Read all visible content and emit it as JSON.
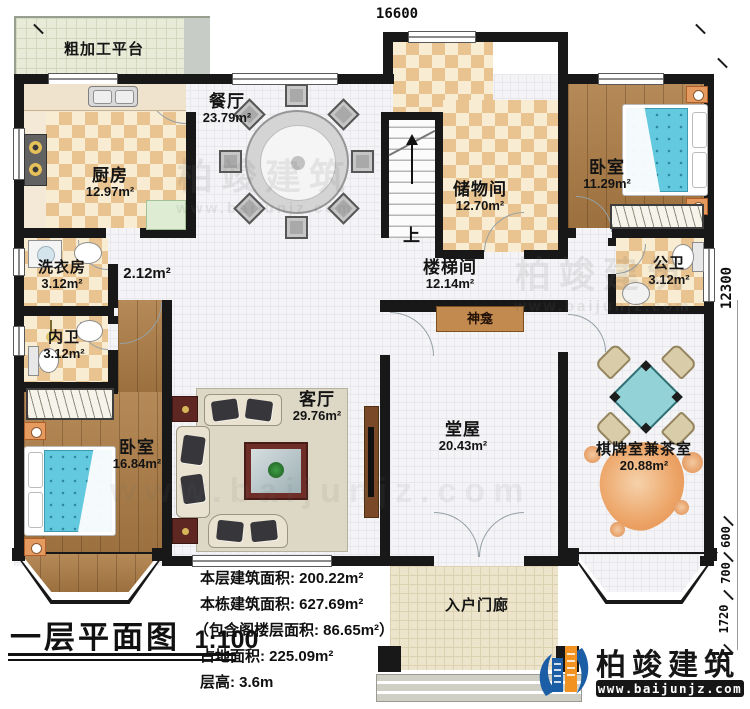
{
  "title": {
    "name": "一层平面图",
    "scale": "1:100"
  },
  "dimensions": {
    "top_width": "16600",
    "right_total": "12300",
    "right_seg_600": "600",
    "right_seg_700": "700",
    "right_seg_1720": "1720"
  },
  "rooms": {
    "platform": {
      "name": "粗加工平台"
    },
    "kitchen": {
      "name": "厨房",
      "area": "12.97m²"
    },
    "dining": {
      "name": "餐厅",
      "area": "23.79m²"
    },
    "storage": {
      "name": "储物间",
      "area": "12.70m²"
    },
    "bedroom_ne": {
      "name": "卧室",
      "area": "11.29m²"
    },
    "laundry": {
      "name": "洗衣房",
      "area": "3.12m²"
    },
    "corridor": {
      "area": "2.12m²"
    },
    "stair_hall": {
      "name": "楼梯间",
      "area": "12.14m²"
    },
    "public_bath": {
      "name": "公卫",
      "area": "3.12m²"
    },
    "private_bath": {
      "name": "内卫",
      "area": "3.12m²"
    },
    "bedroom_sw": {
      "name": "卧室",
      "area": "16.84m²"
    },
    "living": {
      "name": "客厅",
      "area": "29.76m²"
    },
    "main_hall": {
      "name": "堂屋",
      "area": "20.43m²"
    },
    "shrine": {
      "name": "神龛"
    },
    "game_room": {
      "name": "棋牌室兼茶室",
      "area": "20.88m²"
    },
    "porch": {
      "name": "入户门廊"
    }
  },
  "stairs": {
    "up_label": "上"
  },
  "stats": {
    "lines": [
      "本层建筑面积: 200.22m²",
      "本栋建筑面积: 627.69m²",
      "（包含阁楼层面积: 86.65m²）",
      "占地面积: 225.09m²",
      "层高: 3.6m"
    ]
  },
  "logo": {
    "company": "柏竣建筑",
    "website": "www.baijunjz.com"
  },
  "watermark": {
    "company": "柏竣建筑",
    "website": "www.baijunjz.com"
  },
  "colors": {
    "wall": "#181818",
    "checker_a": "#e9c490",
    "checker_b": "#f8ecd2",
    "bed": "#62c9de",
    "accent_orange": "#e59a60",
    "mahjong": "#93d2d6",
    "logo_blue": "#1b5ea6",
    "logo_orange": "#f29221"
  }
}
